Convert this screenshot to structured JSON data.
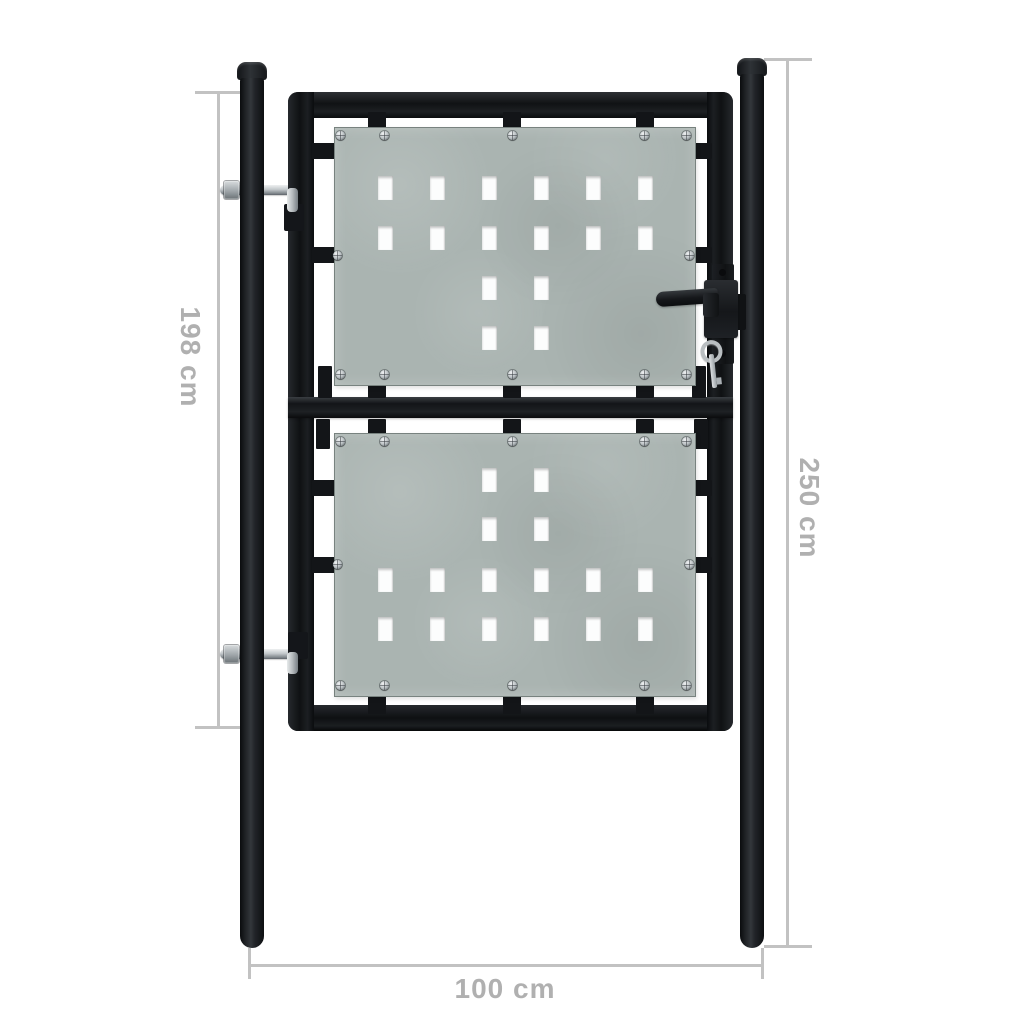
{
  "canvas": {
    "width": 1024,
    "height": 1024,
    "background": "#ffffff"
  },
  "subject": "black single-door garden fence gate with two perforated galvanized steel panels, two round posts, door handle with key, and dimension annotations",
  "colors": {
    "steel_black": "#17191c",
    "steel_highlight": "#33373b",
    "panel_galvanized": "#aab4b1",
    "hole_white": "#fcfdfd",
    "metal_silver": "#c3c8cb",
    "dimension_line": "#c2c2c2",
    "dimension_text": "#b0b0b0"
  },
  "dimensions": {
    "gate_height": {
      "label": "198 cm",
      "orientation": "vertical",
      "side": "left"
    },
    "total_height": {
      "label": "250 cm",
      "orientation": "vertical",
      "side": "right"
    },
    "width": {
      "label": "100 cm",
      "orientation": "horizontal",
      "side": "bottom"
    }
  },
  "gate": {
    "hole": {
      "w": 15,
      "h": 24
    },
    "columns": [
      44,
      96,
      148,
      200,
      252,
      304
    ],
    "panels": [
      {
        "name": "top-panel",
        "x": 334,
        "y": 127,
        "w": 360,
        "h": 257,
        "rows": [
          {
            "y": 49,
            "cols": [
              0,
              1,
              2,
              3,
              4,
              5
            ]
          },
          {
            "y": 99,
            "cols": [
              0,
              1,
              2,
              3,
              4,
              5
            ]
          },
          {
            "y": 149,
            "cols": [
              2,
              3
            ]
          },
          {
            "y": 199,
            "cols": [
              2,
              3
            ]
          }
        ],
        "screws": [
          [
            6,
            8
          ],
          [
            50,
            8
          ],
          [
            178,
            8
          ],
          [
            310,
            8
          ],
          [
            352,
            8
          ],
          [
            6,
            247
          ],
          [
            50,
            247
          ],
          [
            178,
            247
          ],
          [
            310,
            247
          ],
          [
            352,
            247
          ],
          [
            3,
            128
          ],
          [
            355,
            128
          ]
        ]
      },
      {
        "name": "bottom-panel",
        "x": 334,
        "y": 433,
        "w": 360,
        "h": 262,
        "rows": [
          {
            "y": 35,
            "cols": [
              2,
              3
            ]
          },
          {
            "y": 84,
            "cols": [
              2,
              3
            ]
          },
          {
            "y": 135,
            "cols": [
              0,
              1,
              2,
              3,
              4,
              5
            ]
          },
          {
            "y": 184,
            "cols": [
              0,
              1,
              2,
              3,
              4,
              5
            ]
          }
        ],
        "screws": [
          [
            6,
            8
          ],
          [
            50,
            8
          ],
          [
            178,
            8
          ],
          [
            310,
            8
          ],
          [
            352,
            8
          ],
          [
            6,
            252
          ],
          [
            50,
            252
          ],
          [
            178,
            252
          ],
          [
            310,
            252
          ],
          [
            352,
            252
          ],
          [
            3,
            131
          ],
          [
            355,
            131
          ]
        ]
      }
    ],
    "clips": [
      [
        368,
        112,
        18,
        28
      ],
      [
        503,
        112,
        18,
        28
      ],
      [
        636,
        112,
        18,
        28
      ],
      [
        312,
        143,
        24,
        16
      ],
      [
        688,
        143,
        24,
        16
      ],
      [
        312,
        247,
        24,
        16
      ],
      [
        688,
        247,
        24,
        16
      ],
      [
        368,
        370,
        18,
        28
      ],
      [
        503,
        370,
        18,
        28
      ],
      [
        636,
        370,
        18,
        28
      ],
      [
        318,
        366,
        14,
        32
      ],
      [
        692,
        366,
        14,
        32
      ],
      [
        368,
        419,
        18,
        28
      ],
      [
        503,
        419,
        18,
        28
      ],
      [
        636,
        419,
        18,
        28
      ],
      [
        316,
        419,
        14,
        30
      ],
      [
        694,
        419,
        14,
        30
      ],
      [
        312,
        480,
        24,
        16
      ],
      [
        688,
        480,
        24,
        16
      ],
      [
        312,
        557,
        24,
        16
      ],
      [
        688,
        557,
        24,
        16
      ],
      [
        368,
        686,
        18,
        28
      ],
      [
        503,
        686,
        18,
        28
      ],
      [
        636,
        686,
        18,
        28
      ]
    ]
  }
}
